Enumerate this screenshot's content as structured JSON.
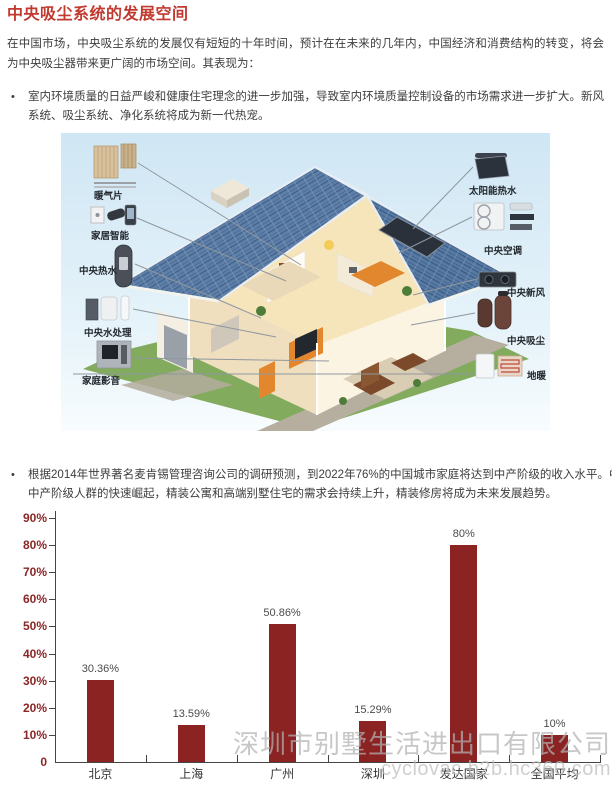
{
  "title": "中央吸尘系统的发展空间",
  "intro": "在中国市场，中央吸尘系统的发展仅有短短的十年时间，预计在在未来的几年内，中国经济和消费结构的转变，将会为中央吸尘器带来更广阔的市场空间。其表现为：",
  "bullets": [
    "室内环境质量的日益严峻和健康住宅理念的进一步加强，导致室内环境质量控制设备的市场需求进一步扩大。新风系统、吸尘系统、净化系统将成为新一代热宠。",
    "根据2014年世界著名麦肯锡管理咨询公司的调研预测，到2022年76%的中国城市家庭将达到中产阶级的收入水平。中国中产阶级人群的快速崛起，精装公寓和高端别墅住宅的需求会持续上升，精装修房将成为未来发展趋势。"
  ],
  "figure": {
    "callouts": [
      {
        "label": "暖气片"
      },
      {
        "label": "家居智能"
      },
      {
        "label": "中央热水"
      },
      {
        "label": "中央水处理"
      },
      {
        "label": "家庭影音"
      },
      {
        "label": "太阳能热水"
      },
      {
        "label": "中央空调"
      },
      {
        "label": "中央新风"
      },
      {
        "label": "中央吸尘"
      },
      {
        "label": "地暖"
      }
    ]
  },
  "chart_data": {
    "type": "bar",
    "categories": [
      "北京",
      "上海",
      "广州",
      "深圳",
      "发达国家",
      "全国平均"
    ],
    "values": [
      30.36,
      13.59,
      50.86,
      15.29,
      80,
      10
    ],
    "value_labels": [
      "30.36%",
      "13.59%",
      "50.86%",
      "15.29%",
      "80%",
      "10%"
    ],
    "y_ticks": [
      "90%",
      "80%",
      "70%",
      "60%",
      "50%",
      "40%",
      "30%",
      "20%",
      "10%",
      "0"
    ],
    "ylim": [
      0,
      90
    ],
    "title": "",
    "xlabel": "",
    "ylabel": "",
    "grid": false,
    "legend": false,
    "bar_color": "#8B2323"
  },
  "watermark": {
    "line1": "深圳市别墅生活进出口有限公司",
    "line2": "cyclovac.b2b.hc360.com"
  },
  "colors": {
    "accent_red": "#C13A30",
    "bar_maroon": "#8B2323",
    "y_label_maroon": "#8B2626",
    "watermark_gray": "#b2b2b2"
  }
}
